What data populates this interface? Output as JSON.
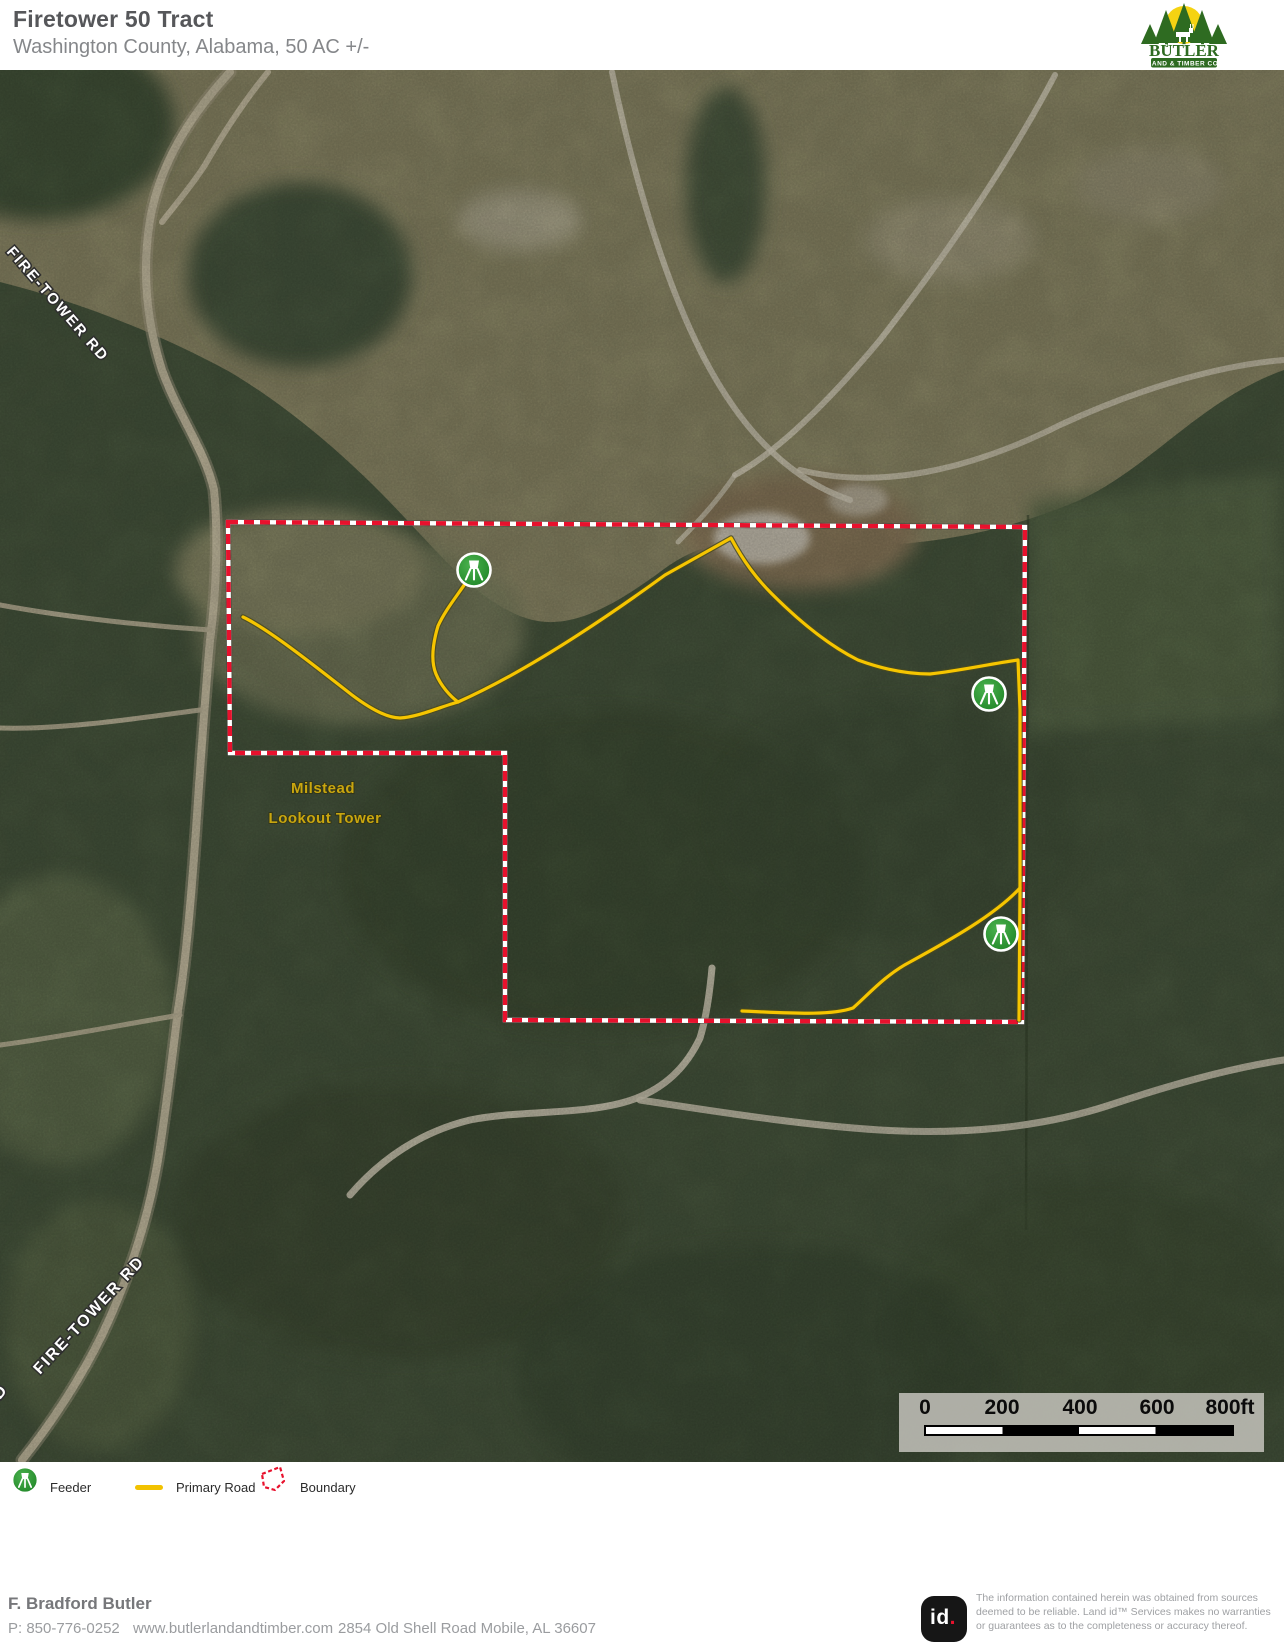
{
  "header": {
    "title": "Firetower 50 Tract",
    "subtitle": "Washington County, Alabama, 50 AC +/-",
    "logo": {
      "name": "BUTLER",
      "tagline": "LAND & TIMBER CO."
    }
  },
  "map": {
    "road_label_top": "FIRE-TOWER RD",
    "road_label_bottom": "FIRE-TOWER RD",
    "road_label_corner": "D",
    "tower_label_line1": "Milstead",
    "tower_label_line2": "Lookout Tower",
    "scalebar": {
      "ticks": [
        "0",
        "200",
        "400",
        "600",
        "800ft"
      ]
    },
    "colors": {
      "boundary": "#e8112d",
      "primary_road": "#f6c500",
      "feeder": "#2f9e33"
    }
  },
  "legend": {
    "items": [
      {
        "label": "Feeder"
      },
      {
        "label": "Primary Road"
      },
      {
        "label": "Boundary"
      }
    ]
  },
  "footer": {
    "agent": "F. Bradford Butler",
    "phone": "P: 850-776-0252",
    "website": "www.butlerlandandtimber.com",
    "address": "2854 Old Shell Road Mobile, AL 36607",
    "id_text": "id",
    "id_dot": ".",
    "disclaimer": "The information contained herein  was obtained from sources deemed to be reliable.  Land id™ Services makes no warranties or guarantees as to the completeness or accuracy thereof."
  }
}
